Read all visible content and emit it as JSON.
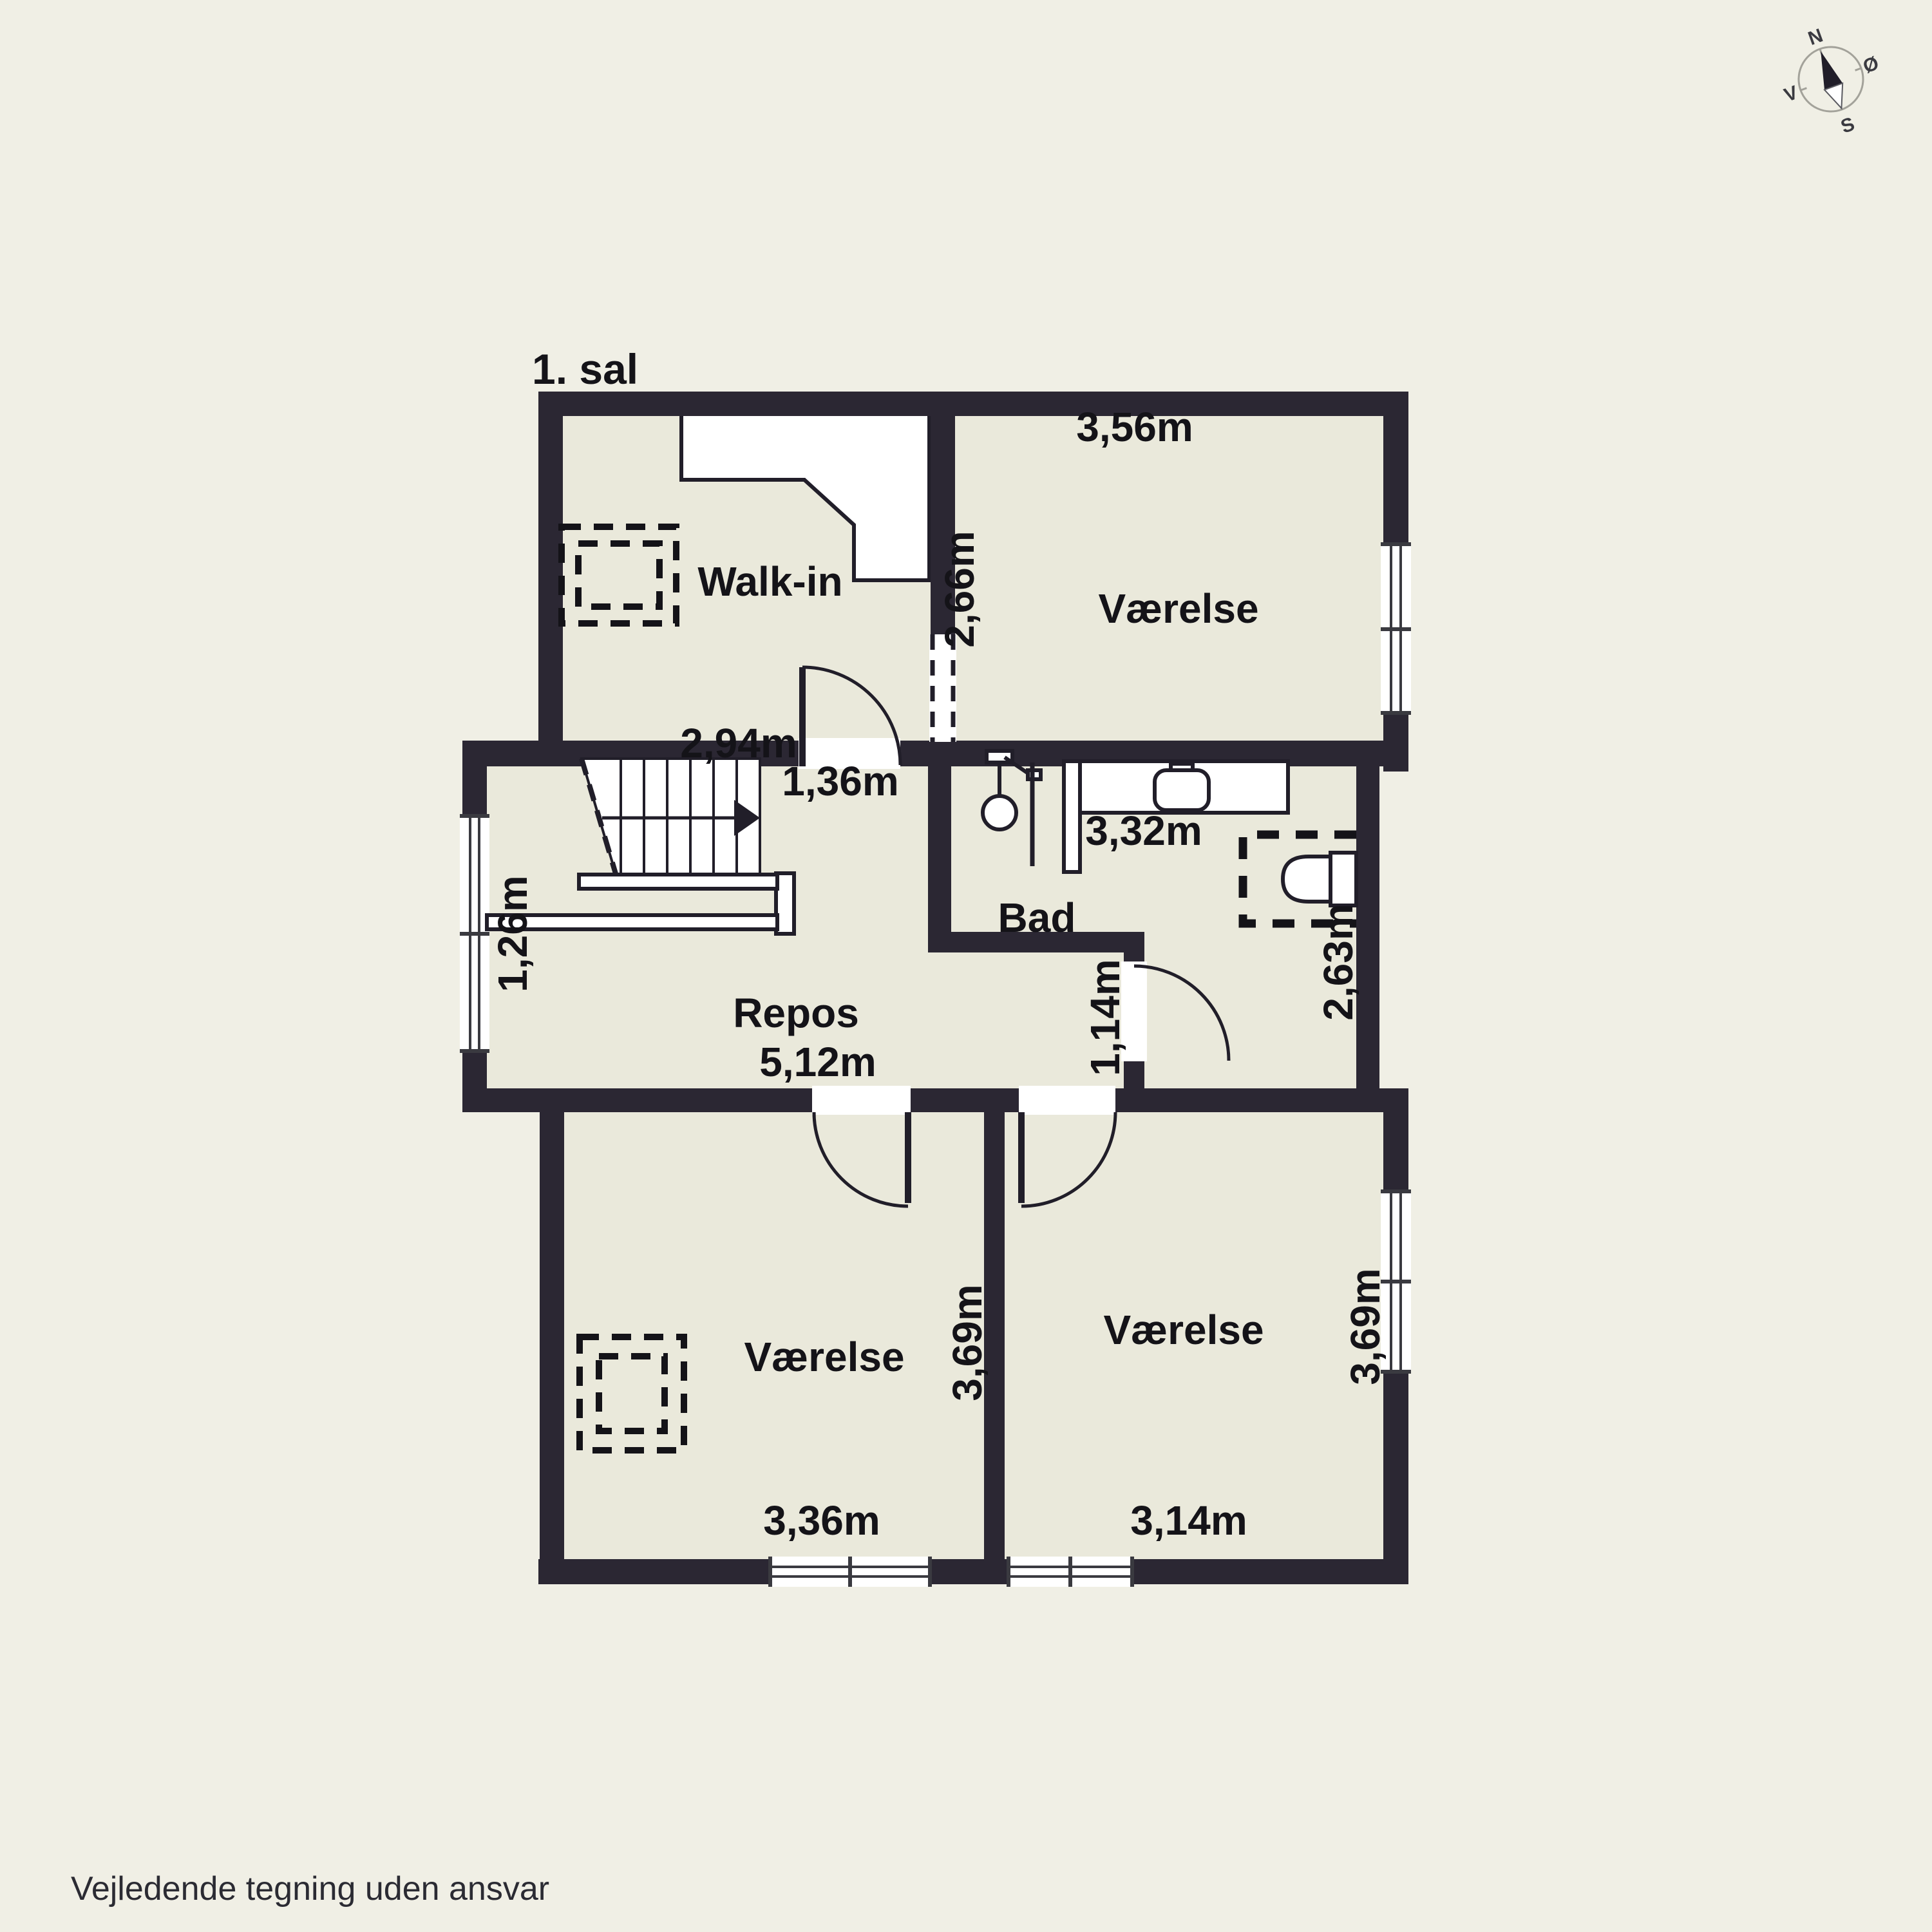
{
  "title": "1. sal",
  "disclaimer": "Vejledende tegning uden ansvar",
  "compass": {
    "north": "N",
    "east": "Ø",
    "south": "S",
    "west": "V"
  },
  "rooms": {
    "walkin": {
      "name": "Walk-in",
      "width": "2,94m"
    },
    "bedroom_ne": {
      "name": "Værelse",
      "width": "3,56m",
      "depth": "2,66m"
    },
    "bath": {
      "name": "Bad",
      "width": "3,32m",
      "depth": "2,63m",
      "door_width": "1,14m"
    },
    "landing": {
      "name": "Repos",
      "width": "5,12m",
      "window_width": "1,26m",
      "door_width": "1,36m"
    },
    "bedroom_sw": {
      "name": "Værelse",
      "width": "3,36m",
      "depth": "3,69m"
    },
    "bedroom_se": {
      "name": "Værelse",
      "width": "3,14m",
      "depth": "3,69m"
    }
  },
  "colors": {
    "background": "#f0efe5",
    "floor": "#eae9db",
    "wall": "#2b2733",
    "text": "#141318"
  }
}
